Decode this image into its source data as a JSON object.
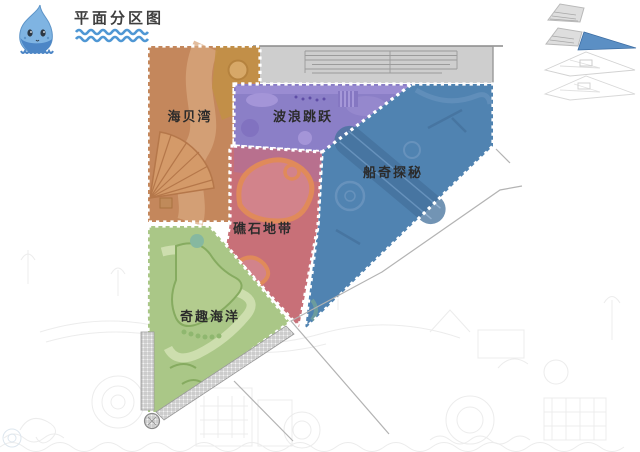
{
  "header": {
    "title": "平面分区图",
    "title_color": "#3f3f3f",
    "wave_color": "#4f97d4",
    "mascot": "water-drop-mascot",
    "mascot_body_color": "#7fb4e2",
    "mascot_base_color": "#4c86c6"
  },
  "zones": [
    {
      "name": "sea-shell-bay",
      "label": "海贝湾",
      "color": "#c4875c",
      "label_color": "#2b2b2b"
    },
    {
      "name": "wave-jump",
      "label": "波浪跳跃",
      "color": "#8b7fc7",
      "label_color": "#2b2b2b"
    },
    {
      "name": "ship-adventure",
      "label": "船奇探秘",
      "color": "#5083b1",
      "label_color": "#2b2b2b"
    },
    {
      "name": "reef-zone",
      "label": "礁石地带",
      "color": "#c87078",
      "label_color": "#2b2b2b"
    },
    {
      "name": "fun-ocean",
      "label": "奇趣海洋",
      "color": "#aac787",
      "label_color": "#2b2b2b"
    }
  ],
  "entrance_strip": {
    "color": "#cecece",
    "line_color": "#8a8a8a"
  },
  "borders": {
    "dot_color": "#ffffff"
  },
  "level_thumbnails": {
    "count": 4,
    "highlighted_index": 2,
    "highlight_color": "#5b8fc4",
    "outline_color": "#c3c3c3"
  }
}
